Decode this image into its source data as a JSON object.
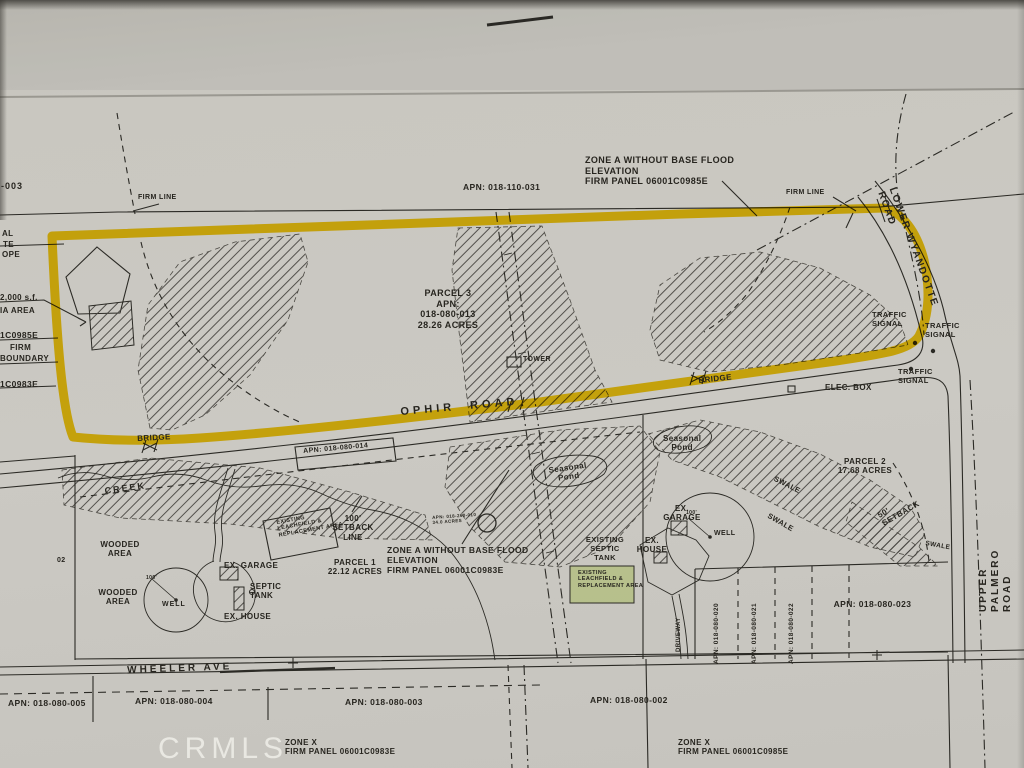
{
  "watermark": "CRMLS",
  "map": {
    "roads": {
      "ophir": "OPHIR ROAD",
      "lower_wyandotte": "LOWER WYANDOTTE ROAD",
      "upper_palmero": "UPPER PALMERO ROAD",
      "wheeler": "WHEELER AVE"
    },
    "parcels": {
      "parcel3": "PARCEL 3\nAPN:\n018-080-013\n28.26 ACRES",
      "parcel2": "PARCEL 2\n17.68 ACRES",
      "parcel1": "PARCEL 1\n22.12 ACRES"
    },
    "apns": {
      "top": "APN: 018-110-031",
      "a014": "APN: 018-080-014",
      "a023": "APN: 018-080-023",
      "a020": "APN: 018-080-020",
      "a021": "APN: 018-080-021",
      "a022": "APN: 018-080-022",
      "a005": "APN: 018-080-005",
      "a004": "APN: 018-080-004",
      "a003": "APN: 018-080-003",
      "a002": "APN: 018-080-002",
      "circled": "APN: 018-260-010\n34.0 ACRES"
    },
    "flood": {
      "zone_a_top": "ZONE A WITHOUT BASE FLOOD\nELEVATION\nFIRM PANEL 06001C0985E",
      "zone_a_bottom": "ZONE A WITHOUT BASE FLOOD\nELEVATION\nFIRM PANEL 06001C0983E",
      "zone_x_left": "ZONE X\nFIRM PANEL 06001C0983E",
      "zone_x_right": "ZONE X\nFIRM PANEL 06001C0985E",
      "firm_line": "FIRM LINE"
    },
    "features": {
      "traffic_signal": "TRAFFIC\nSIGNAL",
      "tower": "TOWER",
      "bridge": "BRIDGE",
      "elec_box": "ELEC. BOX",
      "seasonal_pond": "Seasonal\nPond",
      "creek": "CREEK",
      "wooded_area": "WOODED\nAREA",
      "setback_100": "100'\nSETBACK\nLINE",
      "setback_50": "50'\nSETBACK",
      "leachfield": "EXISTING\nLEACHFIELD &\nREPLACEMENT AREA",
      "existing_septic": "EXISTING\nSEPTIC\nTANK",
      "septic_tank": "SEPTIC\nTANK",
      "ex_garage": "EX. GARAGE",
      "ex_garage_2": "EX.\nGARAGE",
      "ex_house": "EX. HOUSE",
      "ex_house_2": "EX.\nHOUSE",
      "well": "WELL",
      "swale": "SWALE",
      "driveway": "DRIVEWAY",
      "radius_100": "100'"
    },
    "edge_fragments": {
      "f003": "-003",
      "al": "AL",
      "te": "TE",
      "ope": "OPE",
      "sf": "2,000 s.f.",
      "ia_area": "IA AREA",
      "p0985": "1C0985E",
      "firm": "FIRM",
      "boundary": "BOUNDARY",
      "p0983": "1C0983E",
      "f02": "02"
    }
  }
}
